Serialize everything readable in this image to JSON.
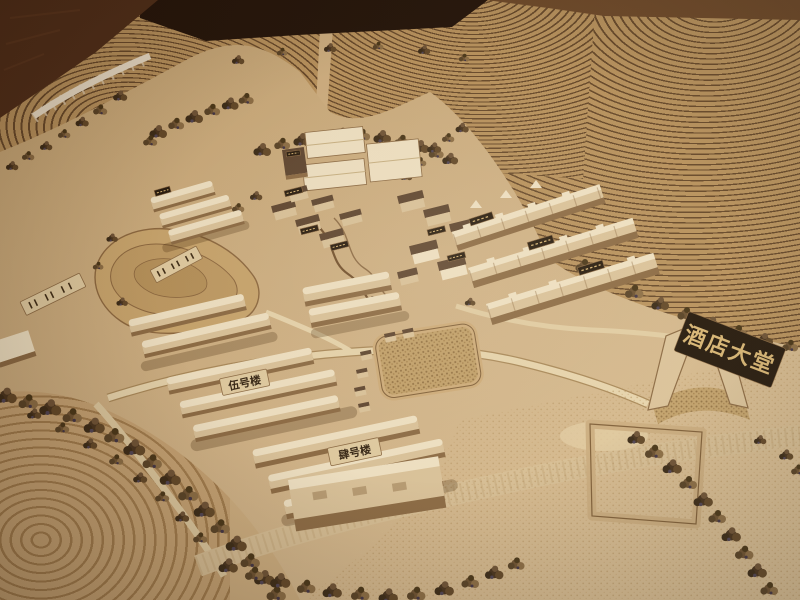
{
  "signs": {
    "hotel_lobby": "酒店大堂",
    "building_no_5": "伍号楼",
    "building_no_4": "肆号楼"
  },
  "colors": {
    "floor_shadow": "#1c0f08",
    "floor_wood": "#4a2a18",
    "floor_wood_light": "#6a4628",
    "terrace_base": "#b8935f",
    "terrace_line": "#64472a",
    "ground": "#cfb184",
    "ground_light": "#dcc49c",
    "building_face": "#dcc69f",
    "building_top": "#f2e6ca",
    "building_shadow": "#8a6a45",
    "roof_dark": "#5a4330",
    "tree_dark": "#43301d",
    "plaque_dark": "#20160c",
    "plaque_gold": "#d9b878",
    "plaque_light": "#e2cfa6",
    "ink": "#2e2012"
  }
}
